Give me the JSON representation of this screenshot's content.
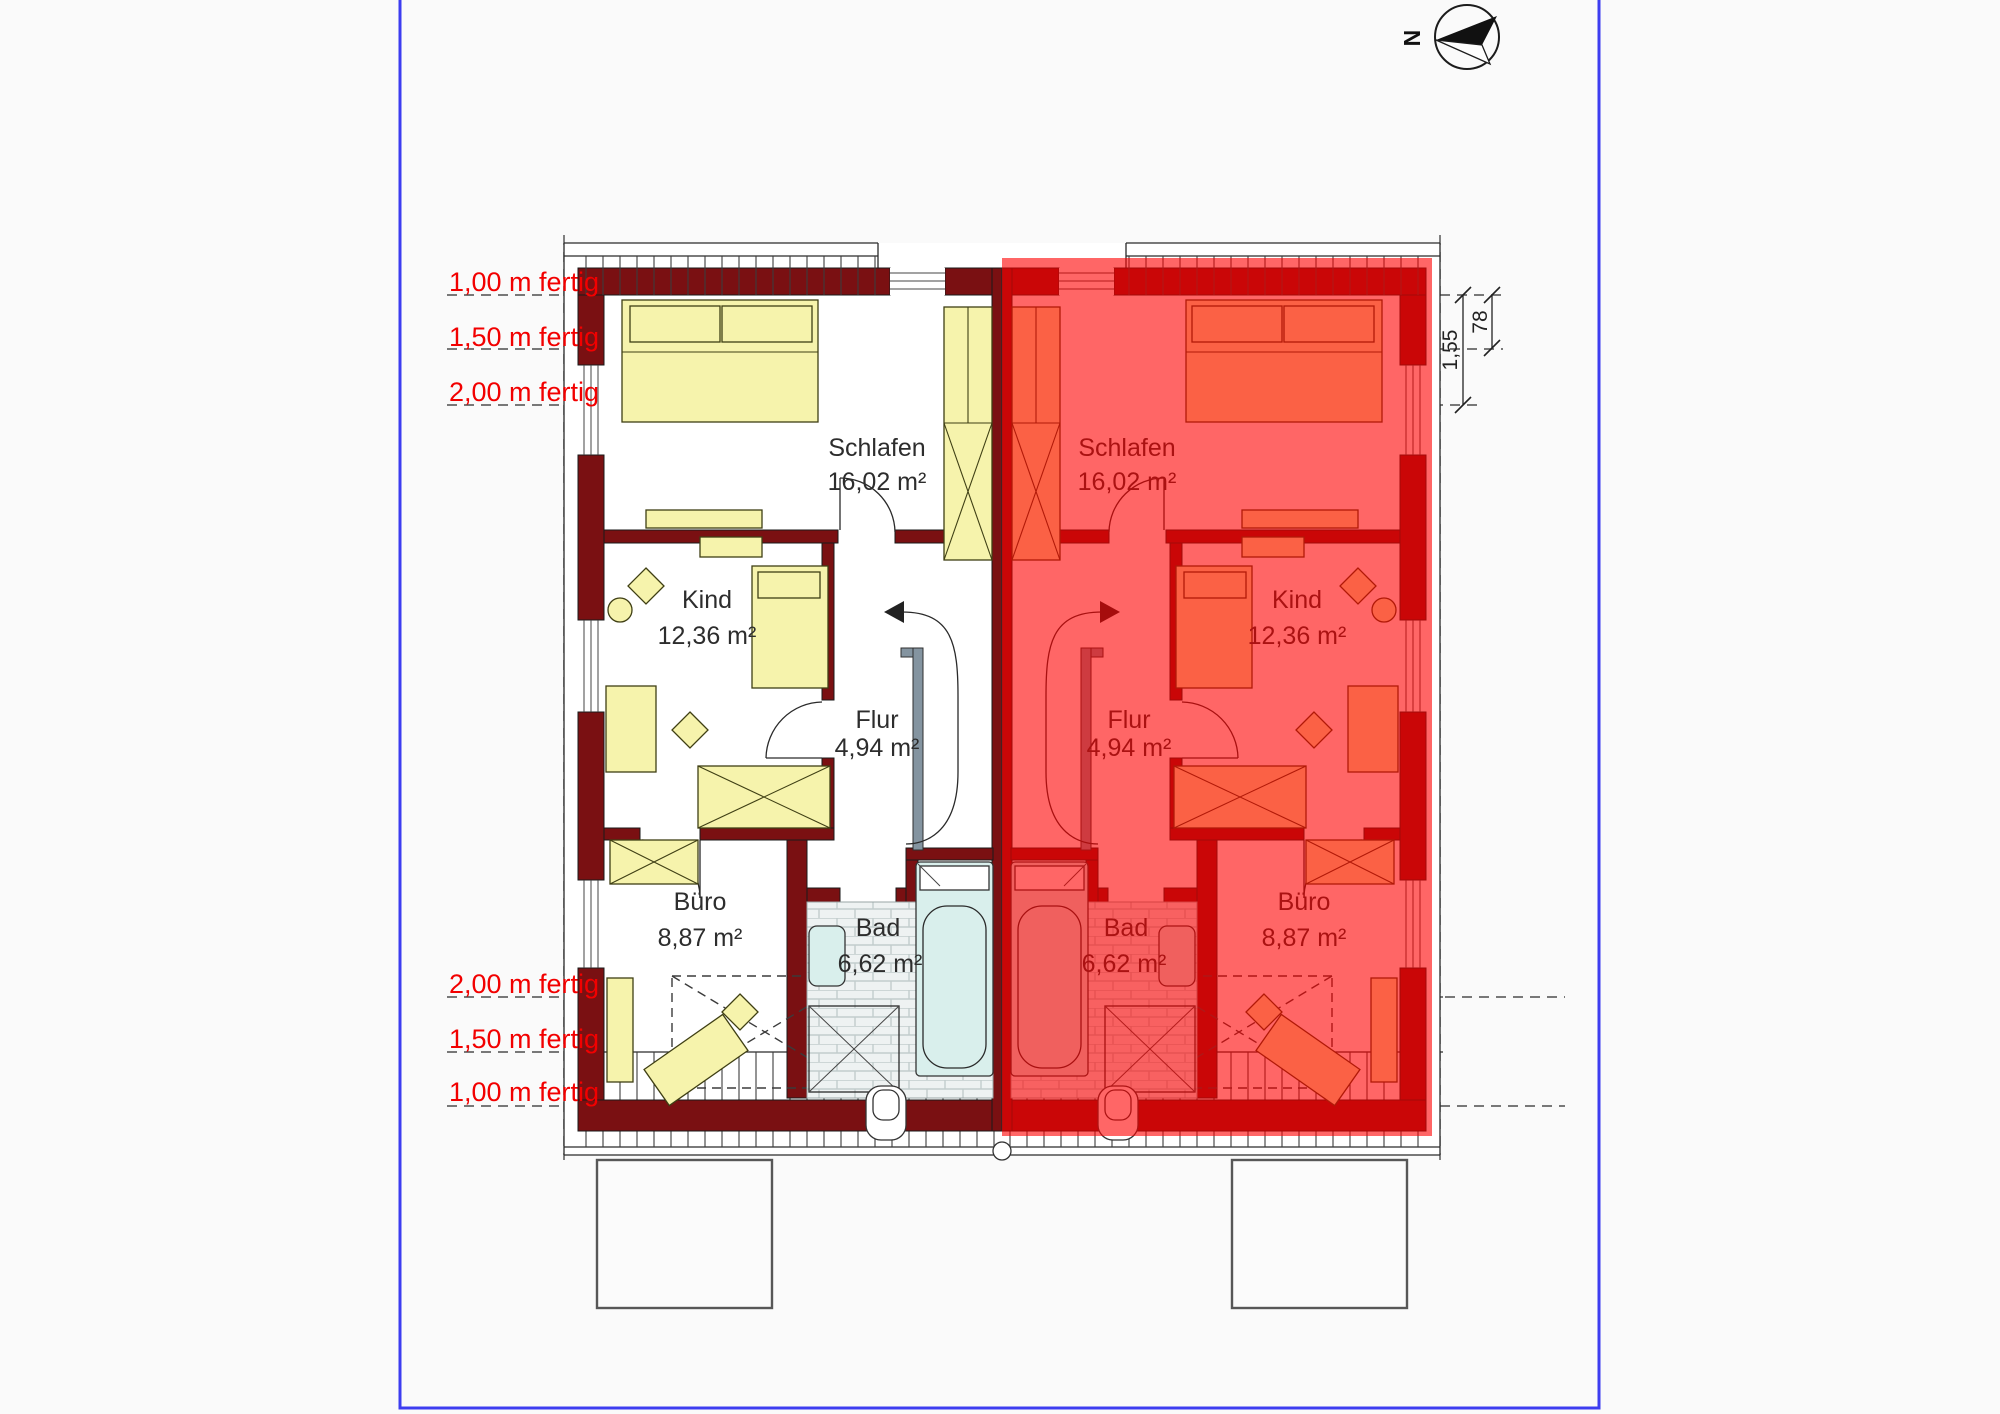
{
  "compass": {
    "north_label": "N"
  },
  "height_lines": {
    "top": [
      "1,00 m fertig",
      "1,50 m fertig",
      "2,00 m fertig"
    ],
    "bottom": [
      "2,00 m fertig",
      "1,50 m fertig",
      "1,00 m fertig"
    ]
  },
  "rooms": {
    "schlafen": {
      "name": "Schlafen",
      "area": "16,02 m²"
    },
    "kind": {
      "name": "Kind",
      "area": "12,36 m²"
    },
    "flur": {
      "name": "Flur",
      "area": "4,94 m²"
    },
    "buero": {
      "name": "Büro",
      "area": "8,87 m²"
    },
    "bad": {
      "name": "Bad",
      "area": "6,62 m²"
    }
  },
  "dimensions": {
    "d78": "78",
    "d155": "1,55"
  },
  "colors": {
    "frame_blue": "#3d3df0",
    "wall_maroon": "#7a1012",
    "overlay_red": "#ff0000",
    "furniture_yellow": "#f6f3ac",
    "tub_cyan": "#d9efec",
    "label_red": "#f20000"
  }
}
